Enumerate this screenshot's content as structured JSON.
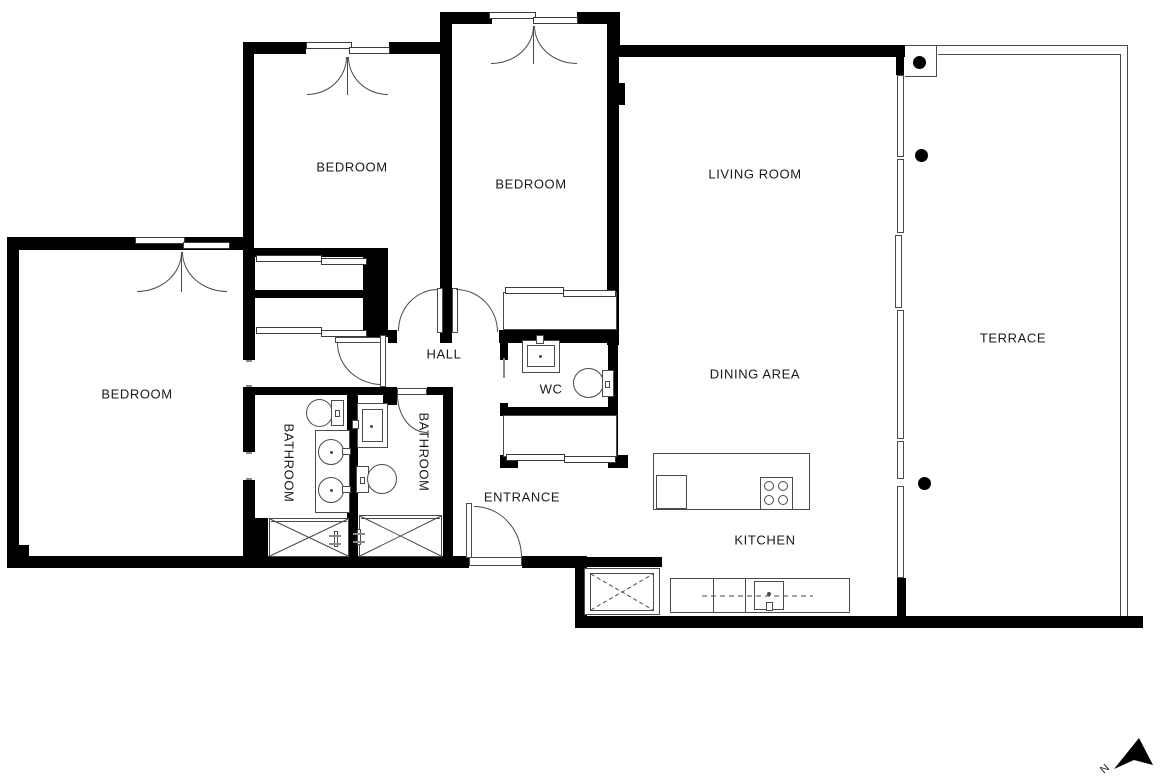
{
  "title": "Apartment floor plan",
  "rooms": [
    {
      "id": "bedroom-top-left",
      "label": "BEDROOM"
    },
    {
      "id": "bedroom-top-middle",
      "label": "BEDROOM"
    },
    {
      "id": "living-room",
      "label": "LIVING ROOM"
    },
    {
      "id": "bedroom-left",
      "label": "BEDROOM"
    },
    {
      "id": "hall",
      "label": "HALL"
    },
    {
      "id": "wc",
      "label": "WC"
    },
    {
      "id": "dining-area",
      "label": "DINING AREA"
    },
    {
      "id": "terrace",
      "label": "TERRACE"
    },
    {
      "id": "bathroom-left",
      "label": "BATHROOM"
    },
    {
      "id": "bathroom-right",
      "label": "BATHROOM"
    },
    {
      "id": "entrance",
      "label": "ENTRANCE"
    },
    {
      "id": "kitchen",
      "label": "KITCHEN"
    }
  ],
  "north_arrow": {
    "label": "N"
  },
  "colors": {
    "wall": "#000000",
    "line": "#4a4a4a",
    "text": "#1a1a1a",
    "background": "#ffffff"
  }
}
